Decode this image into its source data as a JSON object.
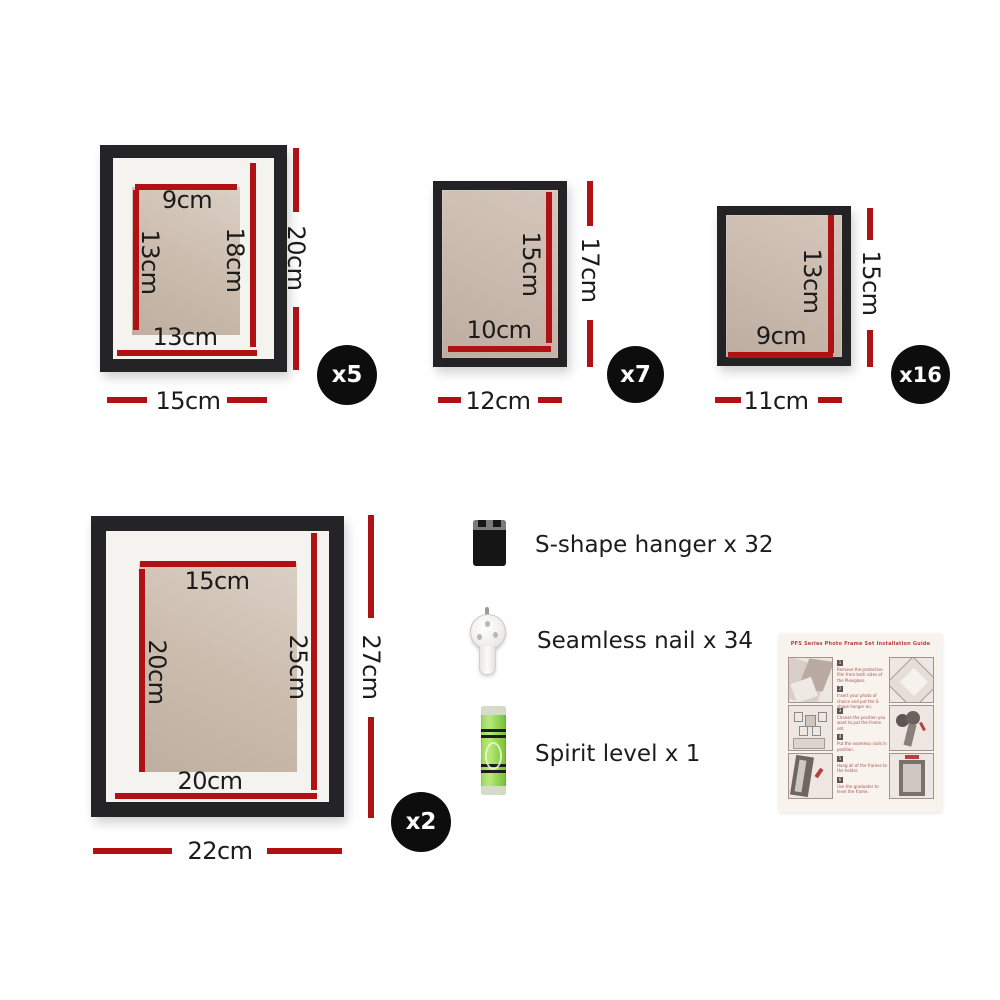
{
  "frames": [
    {
      "name": "photo-frame-15x20",
      "count_badge": "x5",
      "outer": {
        "width": "15cm",
        "height": "20cm"
      },
      "photo": {
        "width": "9cm",
        "height": "13cm"
      },
      "opening": {
        "width": "13cm",
        "height": "18cm"
      }
    },
    {
      "name": "photo-frame-12x17",
      "count_badge": "x7",
      "outer": {
        "width": "12cm",
        "height": "17cm"
      },
      "photo": {
        "width": "10cm",
        "height": "15cm"
      }
    },
    {
      "name": "photo-frame-11x15",
      "count_badge": "x16",
      "outer": {
        "width": "11cm",
        "height": "15cm"
      },
      "photo": {
        "width": "9cm",
        "height": "13cm"
      }
    },
    {
      "name": "photo-frame-22x27",
      "count_badge": "x2",
      "outer": {
        "width": "22cm",
        "height": "27cm"
      },
      "photo": {
        "width": "15cm",
        "height": "20cm"
      },
      "opening": {
        "width": "20cm",
        "height": "25cm"
      }
    }
  ],
  "accessories": [
    {
      "icon": "s-shape-hanger-icon",
      "label": "S-shape hanger x 32"
    },
    {
      "icon": "seamless-nail-icon",
      "label": "Seamless nail x 34"
    },
    {
      "icon": "spirit-level-icon",
      "label": "Spirit level x 1"
    }
  ],
  "manual": {
    "title": "PFS Series Photo Frame Set Installation Guide",
    "steps": [
      {
        "num": "1",
        "text": "Remove the protective film from both sides of the Plexiglass."
      },
      {
        "num": "2",
        "text": "Insert your photo of choice and put the S-shape hanger on."
      },
      {
        "num": "3",
        "text": "Choose the position you want to put the frame set."
      },
      {
        "num": "4",
        "text": "Put the seamless nails in position."
      },
      {
        "num": "5",
        "text": "Hang all of the frames to the holder."
      },
      {
        "num": "6",
        "text": "Use the graduator to level the frame."
      }
    ]
  },
  "colors": {
    "measure_red": "#b01114",
    "badge_black": "#0d0d0d",
    "frame_black": "#242427"
  }
}
